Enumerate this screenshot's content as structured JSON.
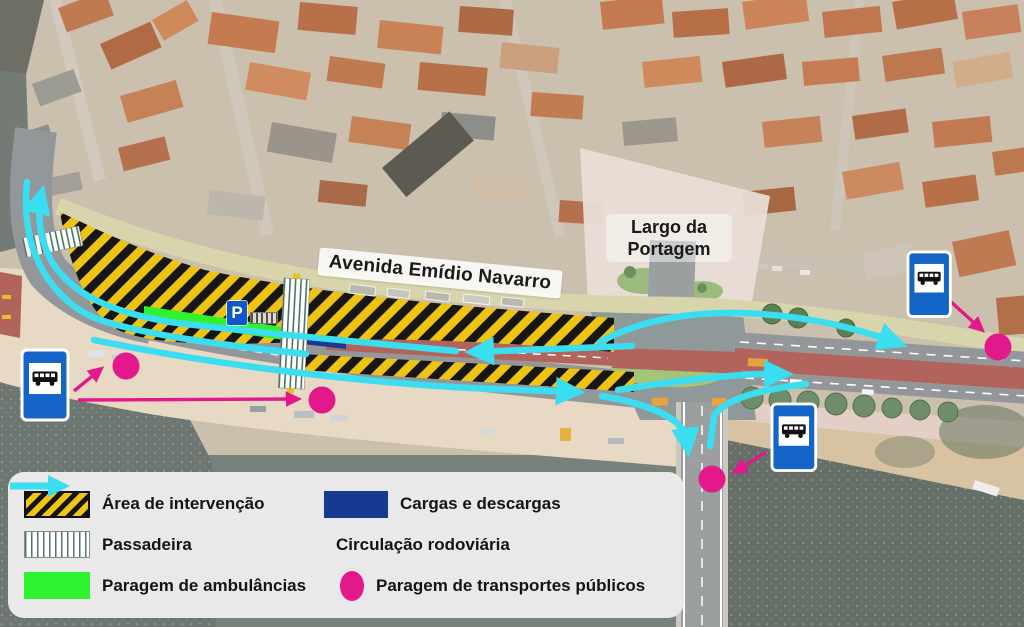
{
  "map": {
    "street_label": "Avenida Emídio Navarro",
    "square_label_line1": "Largo da",
    "square_label_line2": "Portagem",
    "parking_sign_label": "P"
  },
  "legend": {
    "items": [
      {
        "id": "intervention",
        "label": "Área de intervenção"
      },
      {
        "id": "crosswalk",
        "label": "Passadeira"
      },
      {
        "id": "ambulance",
        "label": "Paragem de ambulâncias"
      },
      {
        "id": "loading",
        "label": "Cargas e descargas"
      },
      {
        "id": "traffic",
        "label": "Circulação rodoviária"
      },
      {
        "id": "transit",
        "label": "Paragem de transportes públicos"
      }
    ]
  },
  "colors": {
    "intervention_yellow": "#eec414",
    "intervention_black": "#181612",
    "ambulance_green": "#2ef22e",
    "loading_navy": "#17398f",
    "traffic_cyan": "#3bdef0",
    "transit_magenta": "#e2188b",
    "bus_sign_blue": "#1565c9",
    "road_red": "#b2635c",
    "water_gray": "#666e68"
  }
}
